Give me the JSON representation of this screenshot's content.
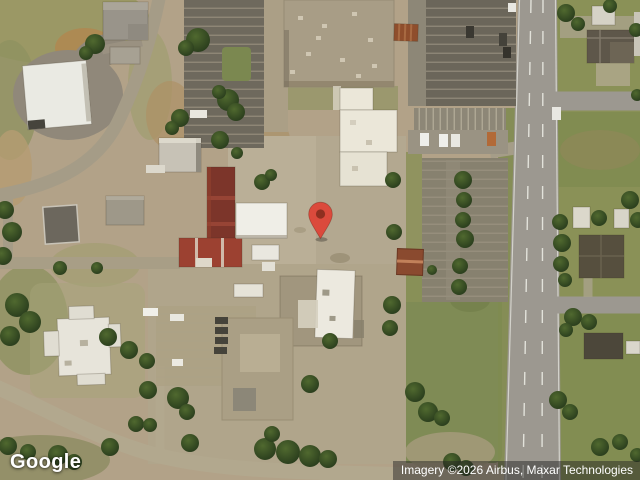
{
  "map": {
    "view_type": "satellite",
    "logo_text": "Google",
    "attribution_text": "Imagery ©2026 Airbus, Maxar Technologies",
    "marker": {
      "label": "location-pin",
      "body_color": "#DB4A3C",
      "dot_color": "#8E2F20",
      "tip_position": {
        "x": 321,
        "y": 241
      }
    },
    "palette": {
      "ground_tan": "#b2a288",
      "grass_green": "#8a9157",
      "tree_green": "#2f451f",
      "road_gray": "#a59c87",
      "highway_gray": "#9c9890",
      "asphalt_dark": "#6e695d",
      "roof_white": "#ebe8dd",
      "roof_tan": "#a89d86",
      "roof_red": "#8e3c2c",
      "roof_dark_gray": "#5e574a"
    }
  }
}
